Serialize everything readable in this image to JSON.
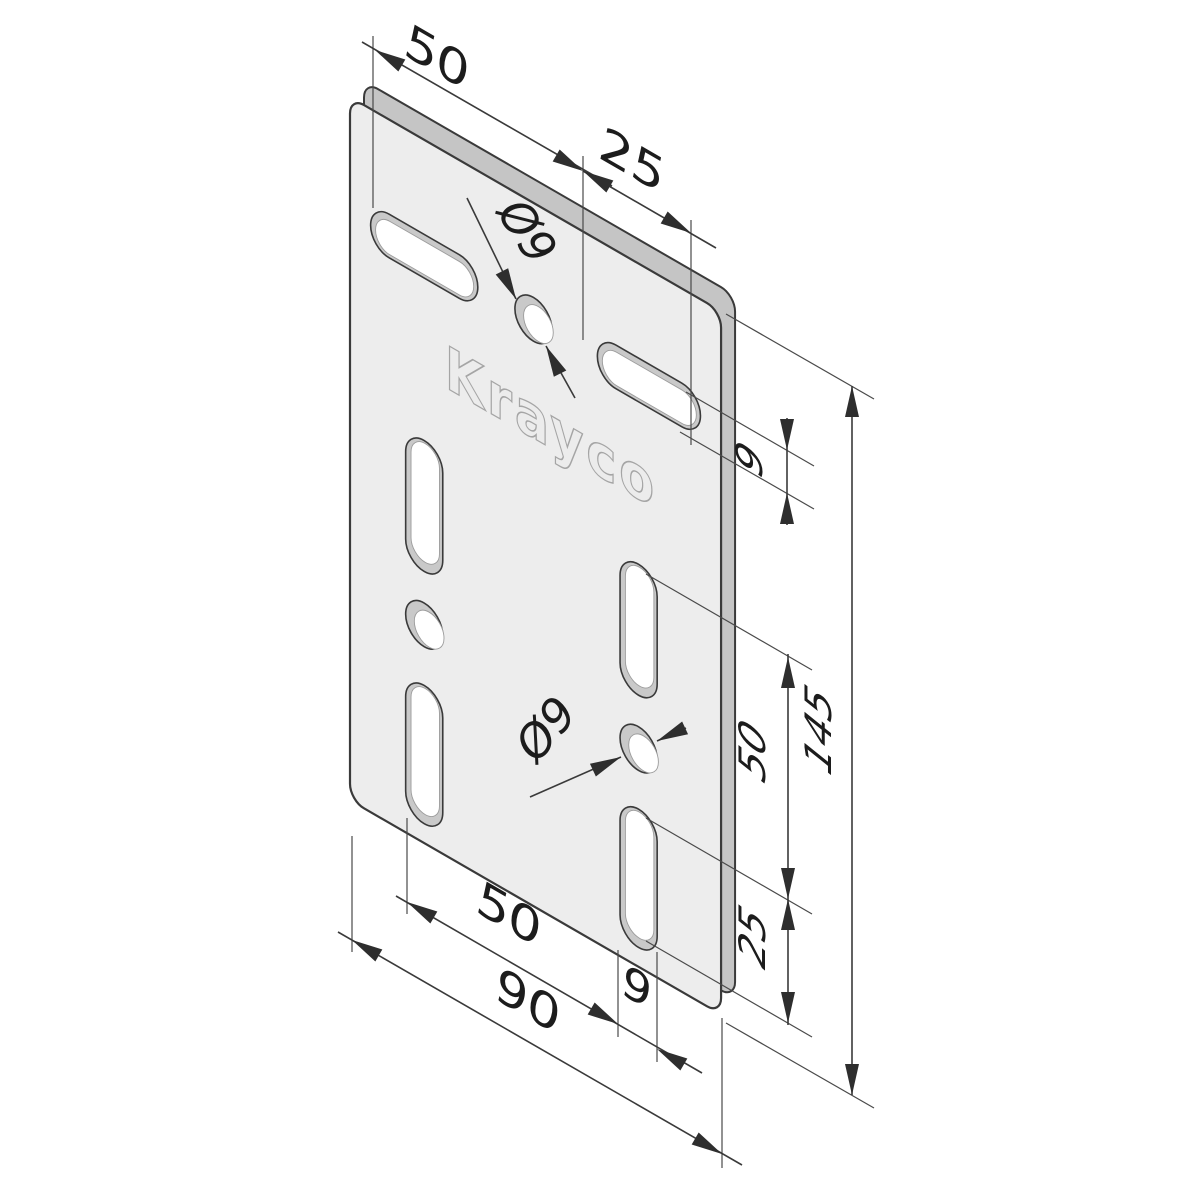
{
  "drawing": {
    "logo": "Krayco",
    "dimensions": {
      "top_width": "50",
      "top_offset": "25",
      "top_hole_dia": "Ø9",
      "right_slot_width": "9",
      "overall_height": "145",
      "right_spacing": "50",
      "right_offset": "25",
      "bottom_spacing": "50",
      "bottom_slot_width": "9",
      "overall_width": "90",
      "bottom_hole_dia": "Ø9"
    },
    "colors": {
      "line": "#3a3a3a",
      "plate_face": "#ededed",
      "plate_side": "#c5c5c5",
      "hole_wall": "#c9c9c9",
      "hole_through": "#ffffff",
      "logo_stroke": "#a5a5a5",
      "background": "#ffffff"
    }
  }
}
